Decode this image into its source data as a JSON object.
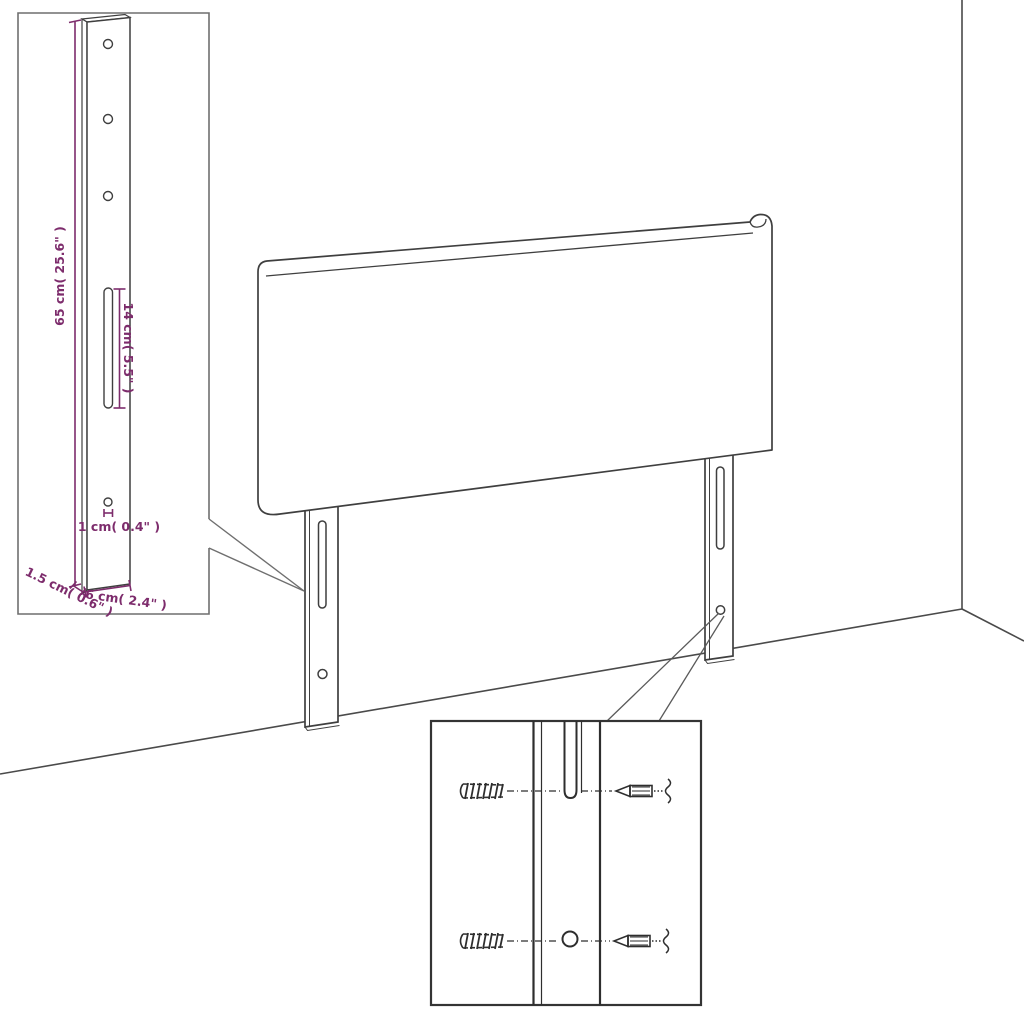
{
  "diagram": {
    "kind": "headboard-assembly-dimension-diagram",
    "colors": {
      "annotation": "#7d2c6c",
      "drawing_line": "#3f3f3f",
      "inset_border": "#6f6f6f",
      "detail_line": "#2e2e2e",
      "background": "#ffffff"
    },
    "labels": {
      "bracket_height": "65 cm( 25.6\" )",
      "slot_length": "14 cm( 5.5\" )",
      "hole_size": "1 cm( 0.4\" )",
      "bracket_thickness": "1.5 cm( 0.6\" )",
      "bracket_width": "6 cm( 2.4\" )"
    }
  }
}
